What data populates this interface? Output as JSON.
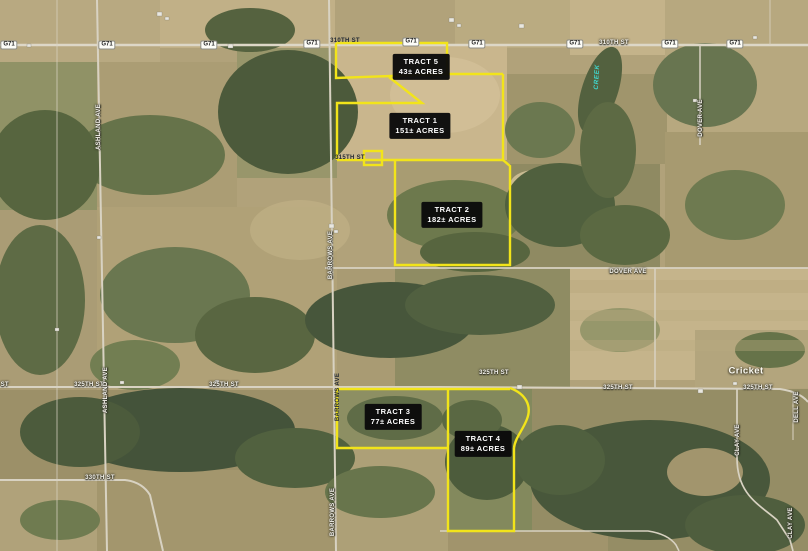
{
  "map": {
    "place": {
      "text": "Cricket"
    },
    "creek": {
      "text": "CREEK"
    },
    "route_shield_label": "G71",
    "colors": {
      "boundary_yellow": "#f2e41a",
      "tract_label_bg": "#0a0a0a",
      "tract_label_text": "#ffffff",
      "road_label_text": "#f7f5ee",
      "road_label_dark_text": "#232a33",
      "creek_text": "#3fd8cf",
      "shield_bg": "#fdfdf8",
      "shield_text": "#1d1d1d"
    },
    "tracts": [
      {
        "name": "TRACT 5",
        "acres": "43± ACRES"
      },
      {
        "name": "TRACT 1",
        "acres": "151± ACRES"
      },
      {
        "name": "TRACT 2",
        "acres": "182± ACRES"
      },
      {
        "name": "TRACT 3",
        "acres": "77± ACRES"
      },
      {
        "name": "TRACT 4",
        "acres": "89± ACRES"
      }
    ],
    "route_shields": [
      {
        "x": 9,
        "y": 45
      },
      {
        "x": 107,
        "y": 45
      },
      {
        "x": 209,
        "y": 45
      },
      {
        "x": 312,
        "y": 44
      },
      {
        "x": 411,
        "y": 42
      },
      {
        "x": 477,
        "y": 44
      },
      {
        "x": 575,
        "y": 44
      },
      {
        "x": 670,
        "y": 44
      },
      {
        "x": 735,
        "y": 44
      }
    ],
    "street_labels": [
      {
        "text": "310TH ST",
        "x": 345,
        "y": 41,
        "dark": true
      },
      {
        "text": "310TH ST",
        "x": 614,
        "y": 43
      },
      {
        "text": "315TH ST",
        "x": 350,
        "y": 158,
        "dark": true
      },
      {
        "text": "DOVER AVE",
        "x": 628,
        "y": 272
      },
      {
        "text": "325TH ST",
        "x": -6,
        "y": 385
      },
      {
        "text": "325TH ST",
        "x": 89,
        "y": 385
      },
      {
        "text": "325TH ST",
        "x": 224,
        "y": 385
      },
      {
        "text": "325TH ST",
        "x": 494,
        "y": 373
      },
      {
        "text": "325TH ST",
        "x": 618,
        "y": 388
      },
      {
        "text": "325TH ST",
        "x": 758,
        "y": 388
      },
      {
        "text": "330TH ST",
        "x": 100,
        "y": 478
      },
      {
        "text": "ASHLAND AVE",
        "x": 99,
        "y": 127,
        "rot": -90
      },
      {
        "text": "ASHLAND AVE",
        "x": 106,
        "y": 390,
        "rot": -90
      },
      {
        "text": "BARROWS AVE",
        "x": 331,
        "y": 255,
        "rot": -90
      },
      {
        "text": "BARROWS AVE",
        "x": 338,
        "y": 397,
        "rot": -90,
        "dark": true
      },
      {
        "text": "BARROWS AVE",
        "x": 333,
        "y": 512,
        "rot": -90
      },
      {
        "text": "DOVER AVE",
        "x": 701,
        "y": 118,
        "rot": -90
      },
      {
        "text": "CLAY AVE",
        "x": 738,
        "y": 440,
        "rot": -90
      },
      {
        "text": "CLAY AVE",
        "x": 791,
        "y": 523,
        "rot": -90
      },
      {
        "text": "DELL AVE",
        "x": 797,
        "y": 407,
        "rot": -90
      }
    ]
  }
}
